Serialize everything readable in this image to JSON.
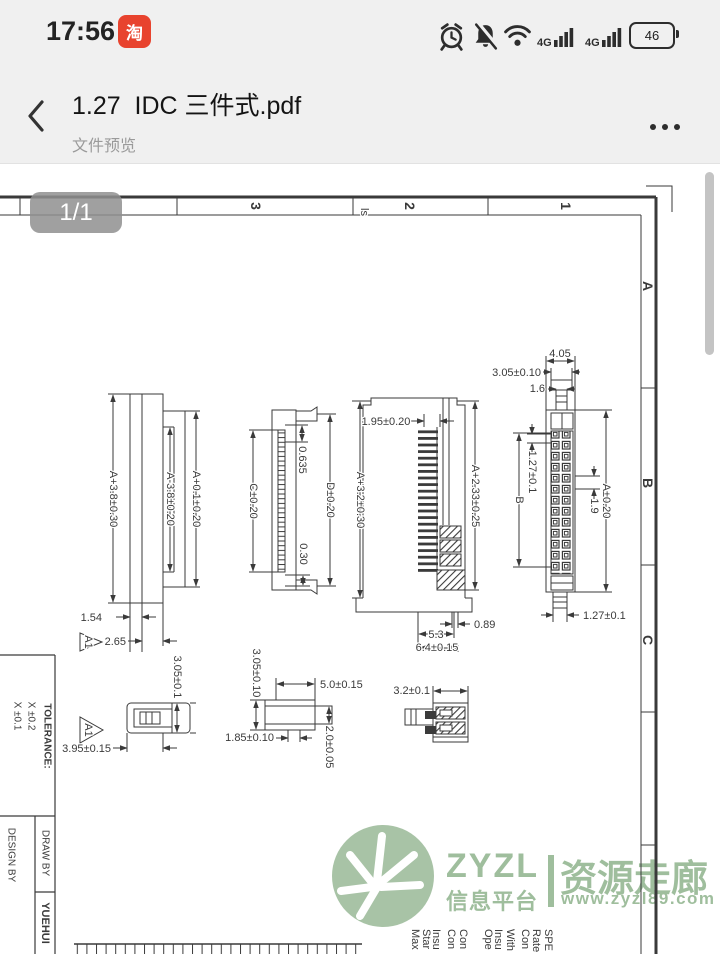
{
  "status_bar": {
    "time": "17:56",
    "taobao_icon_label": "淘",
    "network_label_1": "4G",
    "network_label_2": "4G",
    "battery_percent": "46"
  },
  "header": {
    "title": "1.27  IDC 三件式.pdf",
    "subtitle": "文件预览"
  },
  "viewer": {
    "page_indicator": "1/1"
  },
  "drawing": {
    "zone_top": [
      "3",
      "2",
      "1"
    ],
    "zone_right": [
      "A",
      "B",
      "C"
    ],
    "stray_text": "ls",
    "datum_flag": "A1",
    "v1": {
      "dim_overall": "A+3.8±0.30",
      "dim_inner": "A-3.8±0.20",
      "dim_body": "A+0.1±0.20",
      "dim_plate": "1.54",
      "dim_step": "2.65"
    },
    "v2": {
      "dim_c": "C±0.20",
      "dim_pitch_half": "0.635",
      "dim_d": "D±0.20",
      "dim_tip": "0.30"
    },
    "v3": {
      "dim_top": "1.95±0.20",
      "dim_left": "A+3.2±0.30",
      "dim_right": "A+2.33±0.25",
      "dim_foot": "0.89",
      "dim_width": "5.3",
      "dim_base": "6.4±0.15"
    },
    "v4": {
      "dim_top": "4.05",
      "dim_neck": "3.05±0.10",
      "dim_key": "1.6",
      "dim_pitch": "1.27±0.1",
      "dim_span": "B",
      "dim_gap": "1.9",
      "dim_length": "A±0.20",
      "dim_tail": "1.27±0.1"
    },
    "v5": {
      "dim_height": "3.05±0.1",
      "dim_width": "3.95±0.15"
    },
    "v6": {
      "dim_height": "3.05±0.10",
      "dim_width": "1.85±0.10",
      "dim_length": "5.0±0.15",
      "dim_tab": "2.0±0.05"
    },
    "v7": {
      "dim_width": "3.2±0.1"
    },
    "title_block": {
      "tolerance_label": "TOLERANCE:",
      "tol_row_1": "X ±0.2",
      "tol_row_2": "X ±0.1",
      "draw_by": "DRAW BY",
      "design_by": "DESIGN BY",
      "drafter": "YUEHUI"
    },
    "spec_fragments": [
      "Max",
      "Star",
      "Insu",
      "Con",
      "Con",
      "Ope",
      "Insu",
      "With",
      "Con",
      "Rate",
      "SPE"
    ]
  },
  "watermark": {
    "brand": "ZYZL",
    "brand_sub": "信息平台",
    "name": "资源走廊",
    "url": "www.zyzl89.com"
  },
  "colors": {
    "taobao_red": "#e8432e",
    "icon_dark": "#2d2d2d",
    "watermark_green": "#9fbe9d",
    "badge_gray": "#8f8f8f",
    "header_bg": "#f0f0f0",
    "line_dark": "#3a3a3a"
  }
}
